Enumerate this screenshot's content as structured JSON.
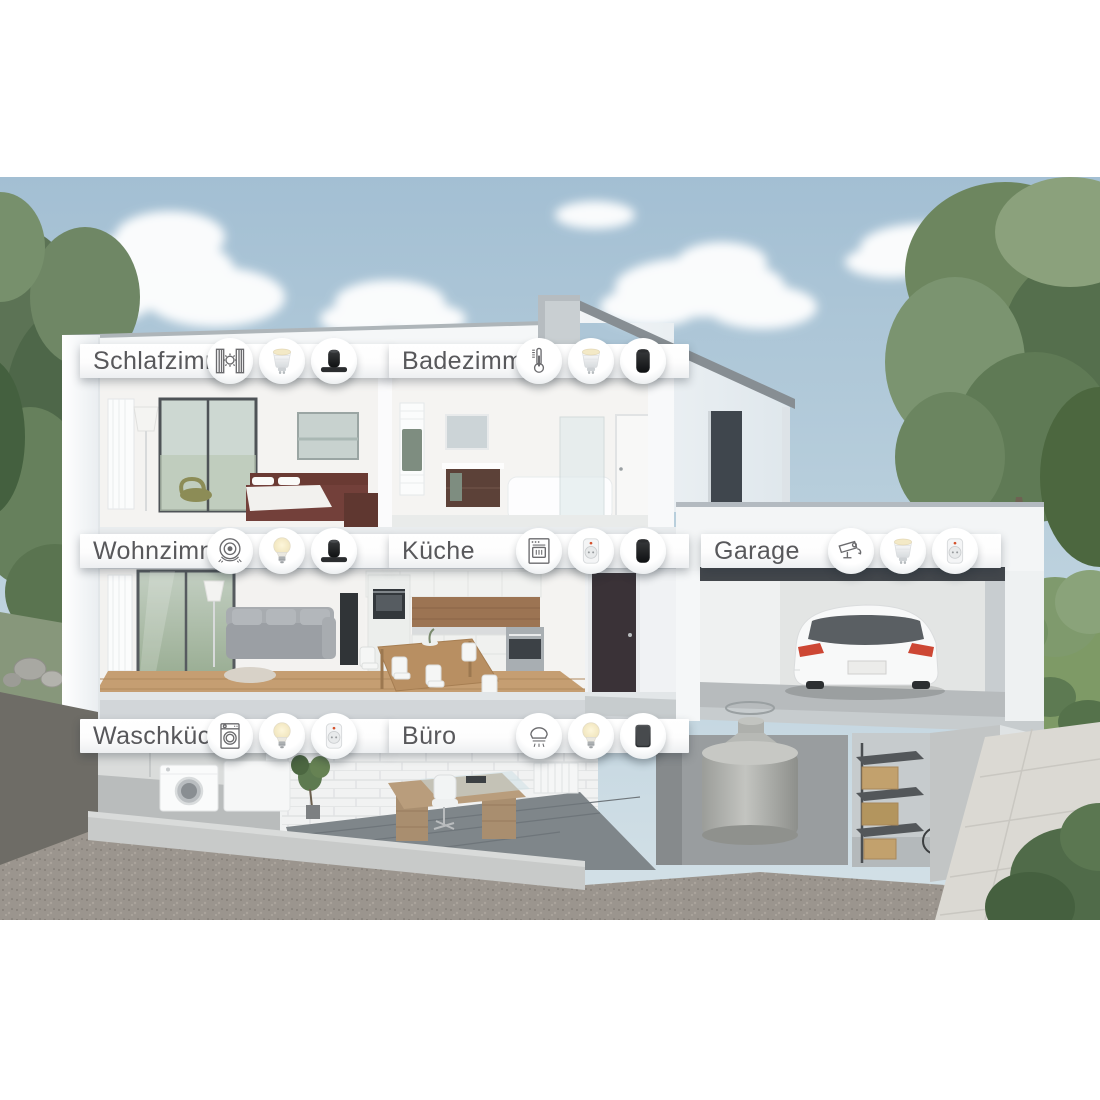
{
  "rooms": [
    {
      "id": "schlafzimmer",
      "label": "Schlafzimmer",
      "devices": [
        "blinds",
        "spot-bulb",
        "speaker-soundbar"
      ]
    },
    {
      "id": "badezimmer",
      "label": "Badezimmer",
      "devices": [
        "thermostat",
        "spot-bulb",
        "speaker"
      ]
    },
    {
      "id": "wohnzimmer",
      "label": "Wohnzimmer",
      "devices": [
        "robot-vacuum",
        "bulb",
        "speaker-soundbar"
      ]
    },
    {
      "id": "kueche",
      "label": "Küche",
      "devices": [
        "oven",
        "smart-plug",
        "speaker"
      ]
    },
    {
      "id": "garage",
      "label": "Garage",
      "devices": [
        "camera",
        "spot-bulb",
        "smart-plug"
      ]
    },
    {
      "id": "waschkueche",
      "label": "Waschküche",
      "devices": [
        "washing-machine",
        "bulb",
        "smart-plug"
      ]
    },
    {
      "id": "buero",
      "label": "Büro",
      "devices": [
        "smoke-detector",
        "bulb",
        "speaker-square"
      ]
    }
  ],
  "palette": {
    "label_text": "#58585b",
    "label_bar": "#ffffff",
    "sky": "#a7c2d4",
    "house_white": "#f3f5f6",
    "tree_green": "#5d7455",
    "device_dark": "#1e2022",
    "led_red": "#d4512c",
    "car_taillight": "#cd4734"
  }
}
